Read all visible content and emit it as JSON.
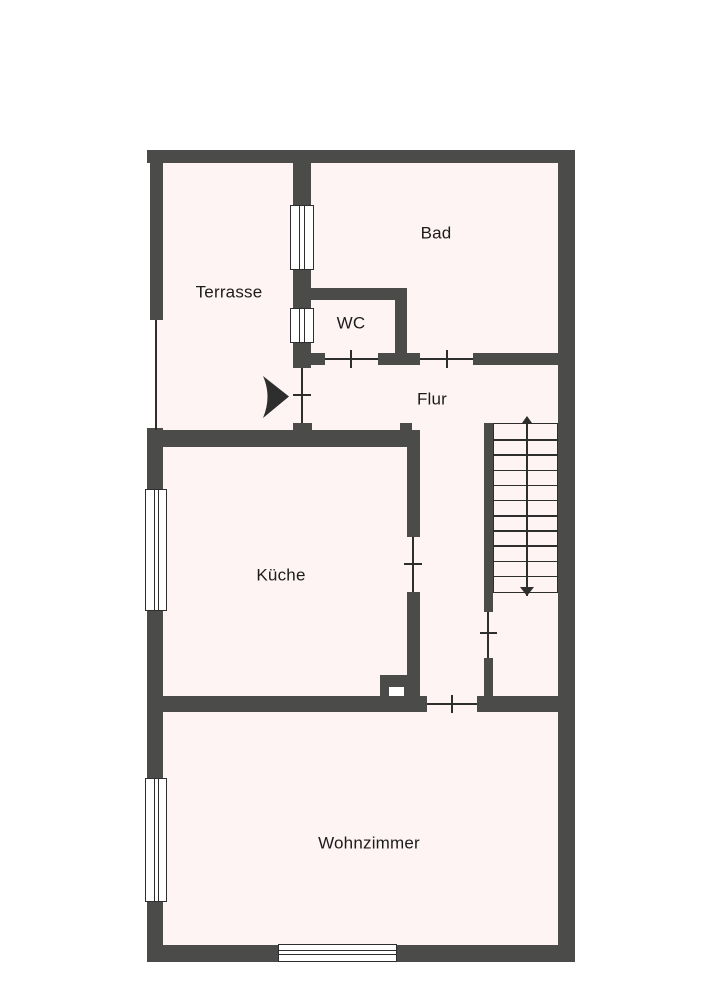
{
  "plan": {
    "type": "floor-plan",
    "rooms": [
      {
        "id": "terrasse",
        "label": "Terrasse"
      },
      {
        "id": "bad",
        "label": "Bad"
      },
      {
        "id": "wc",
        "label": "WC"
      },
      {
        "id": "flur",
        "label": "Flur"
      },
      {
        "id": "kueche",
        "label": "Küche"
      },
      {
        "id": "wohnzimmer",
        "label": "Wohnzimmer"
      }
    ],
    "stairs": {
      "steps": 11,
      "direction": "down",
      "arrow_ends": "both"
    },
    "entrance": {
      "symbol": "black-arrow",
      "from": "Terrasse",
      "into": "Flur"
    },
    "counts": {
      "doors": 6,
      "windows": 5
    },
    "colors": {
      "wall": "#4b4b49",
      "floor": "#fdf4f3",
      "line": "#2e2e2e",
      "background": "#ffffff",
      "text": "#1c1c1c"
    }
  }
}
